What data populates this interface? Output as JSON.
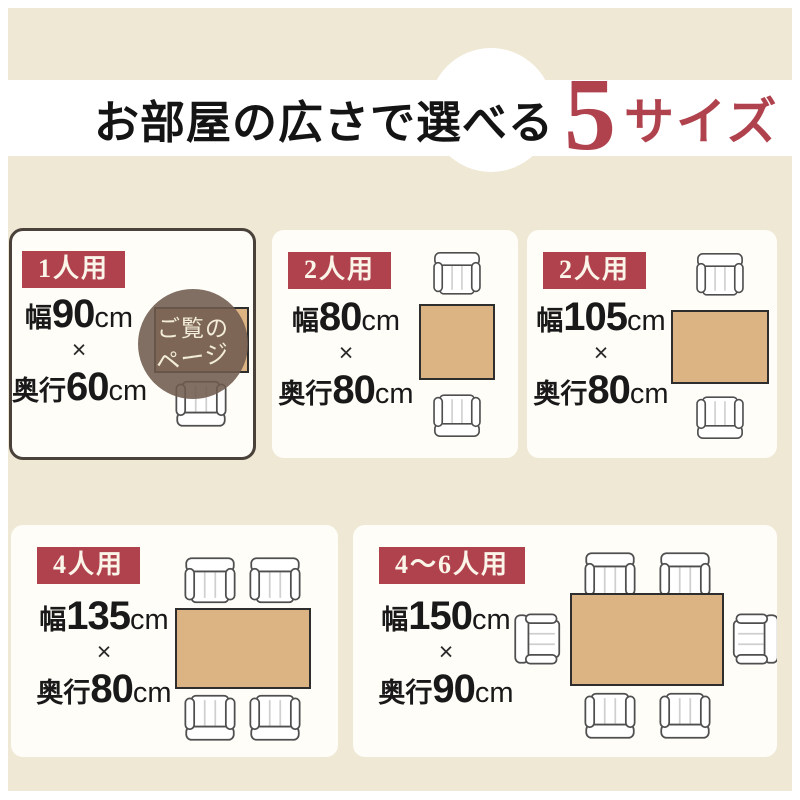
{
  "header": {
    "title_prefix": "お部屋の広さで選べる",
    "title_number": "5",
    "title_suffix": "サイズ"
  },
  "cards": [
    {
      "label": "1人用",
      "width_label": "幅",
      "width_value": "90",
      "width_unit": "cm",
      "times": "×",
      "depth_label": "奥行",
      "depth_value": "60",
      "depth_unit": "cm",
      "table_size_cm": "90×60",
      "chair_count": 1,
      "is_current_page": true,
      "badge": {
        "line1": "ご覧の",
        "line2": "ページ"
      }
    },
    {
      "label": "2人用",
      "width_label": "幅",
      "width_value": "80",
      "width_unit": "cm",
      "times": "×",
      "depth_label": "奥行",
      "depth_value": "80",
      "depth_unit": "cm",
      "table_size_cm": "80×80",
      "chair_count": 2,
      "is_current_page": false
    },
    {
      "label": "2人用",
      "width_label": "幅",
      "width_value": "105",
      "width_unit": "cm",
      "times": "×",
      "depth_label": "奥行",
      "depth_value": "80",
      "depth_unit": "cm",
      "table_size_cm": "105×80",
      "chair_count": 2,
      "is_current_page": false
    },
    {
      "label": "4人用",
      "width_label": "幅",
      "width_value": "135",
      "width_unit": "cm",
      "times": "×",
      "depth_label": "奥行",
      "depth_value": "80",
      "depth_unit": "cm",
      "table_size_cm": "135×80",
      "chair_count": 4,
      "is_current_page": false
    },
    {
      "label": "4〜6人用",
      "width_label": "幅",
      "width_value": "150",
      "width_unit": "cm",
      "times": "×",
      "depth_label": "奥行",
      "depth_value": "90",
      "depth_unit": "cm",
      "table_size_cm": "150×90",
      "chair_count": 6,
      "is_current_page": false
    }
  ],
  "colors": {
    "accent": "#b0424e",
    "table_top": "#dcb483",
    "background": "#efe8d5",
    "badge_circle": "#6f5b4e",
    "current_card_border": "#49413a"
  }
}
